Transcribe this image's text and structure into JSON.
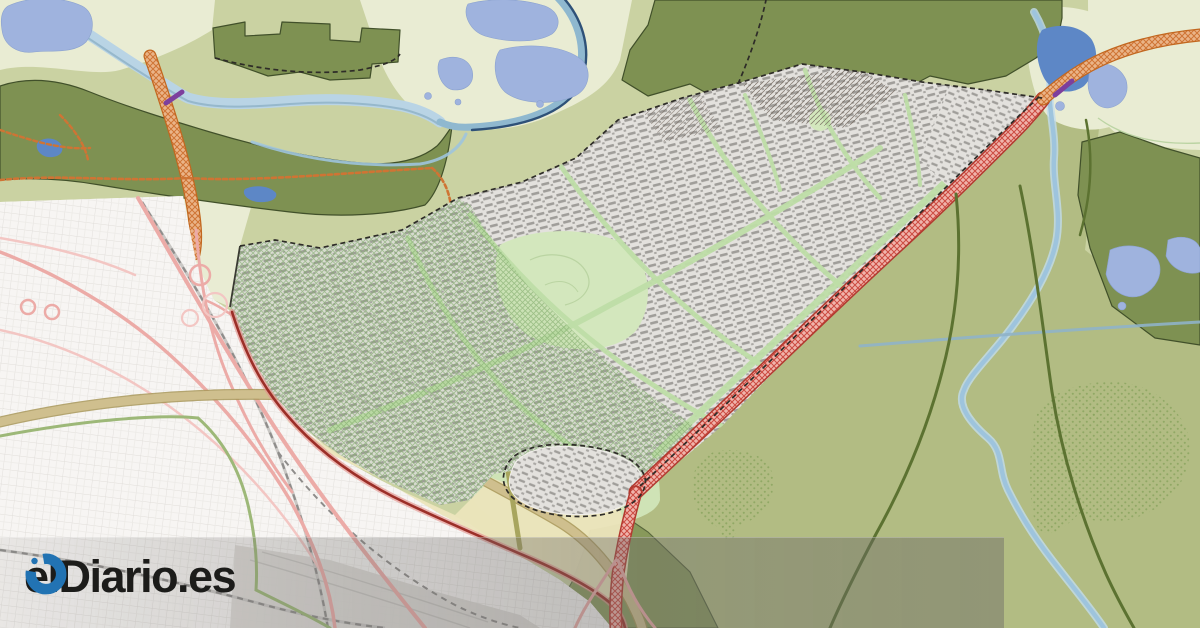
{
  "watermark": {
    "logo_text": "elDiario.es",
    "logo_icon": "eldiario-swirl-icon"
  },
  "map": {
    "kind": "urban-planning-map",
    "features": [
      "planned-urban-development-area",
      "green-hatch-protection-zone",
      "existing-city-street-network",
      "highway-pink-lines",
      "highway-interchange",
      "railway-dashed-line",
      "tan-road-corridor",
      "red-hatched-road-corridor",
      "orange-hatched-road-corridor",
      "orange-dotted-trails",
      "dark-red-boundary-road",
      "dashed-development-boundary",
      "forest-olive-areas",
      "countryside-green",
      "dotted-vegetation-patches",
      "river-and-lakes-northwest",
      "lagoon-lake-cluster",
      "northeast-lake-system",
      "winding-stream-east",
      "canal-line",
      "yellow-reserve-zone",
      "village-cluster",
      "purple-bridge-segments",
      "watermark-band"
    ]
  },
  "palette": {
    "base_green": "#cad2a2",
    "pale_green": "#e9ecd3",
    "medium_green": "#b2bc83",
    "forest_olive": "#7e9152",
    "forest_outline": "#41502a",
    "mint_green": "#cfe3b6",
    "park_green": "#d3e7bd",
    "zone_yellow": "#ebe4bb",
    "water_periwinkle": "#9fb3de",
    "water_deep": "#5d87c6",
    "water_wash": "#b9d4e5",
    "river_teal": "#8fb8cf",
    "river_line": "#2e5178",
    "city_white": "#f7f5f3",
    "street_gray": "#dedbd7",
    "gray_area": "#dbd9d5",
    "dev_base": "#e3e1dd",
    "dev_block": "#a09e9a",
    "dev_green": "#bedda6",
    "hatch_green": "#82ad6d",
    "dots_green": "#8ba55f",
    "road_pink": "#ecaba7",
    "road_pink_light": "#f3c6c3",
    "road_red_dark": "#9c2f28",
    "road_tan": "#cfbf8e",
    "road_tan_edge": "#a89658",
    "road_green": "#9db878",
    "road_olive": "#a8a55e",
    "railway_gray": "#8f8d8b",
    "corridor_red": "#cc4a40",
    "corridor_red_bg": "#f0b4ac",
    "corridor_orange": "#cf7434",
    "corridor_orange_bg": "#eab488",
    "bridge_purple": "#7d3f9d",
    "boundary_dark": "#2e2c28",
    "logo_blue": "#2273b3",
    "logo_text": "#1c1c1a"
  }
}
